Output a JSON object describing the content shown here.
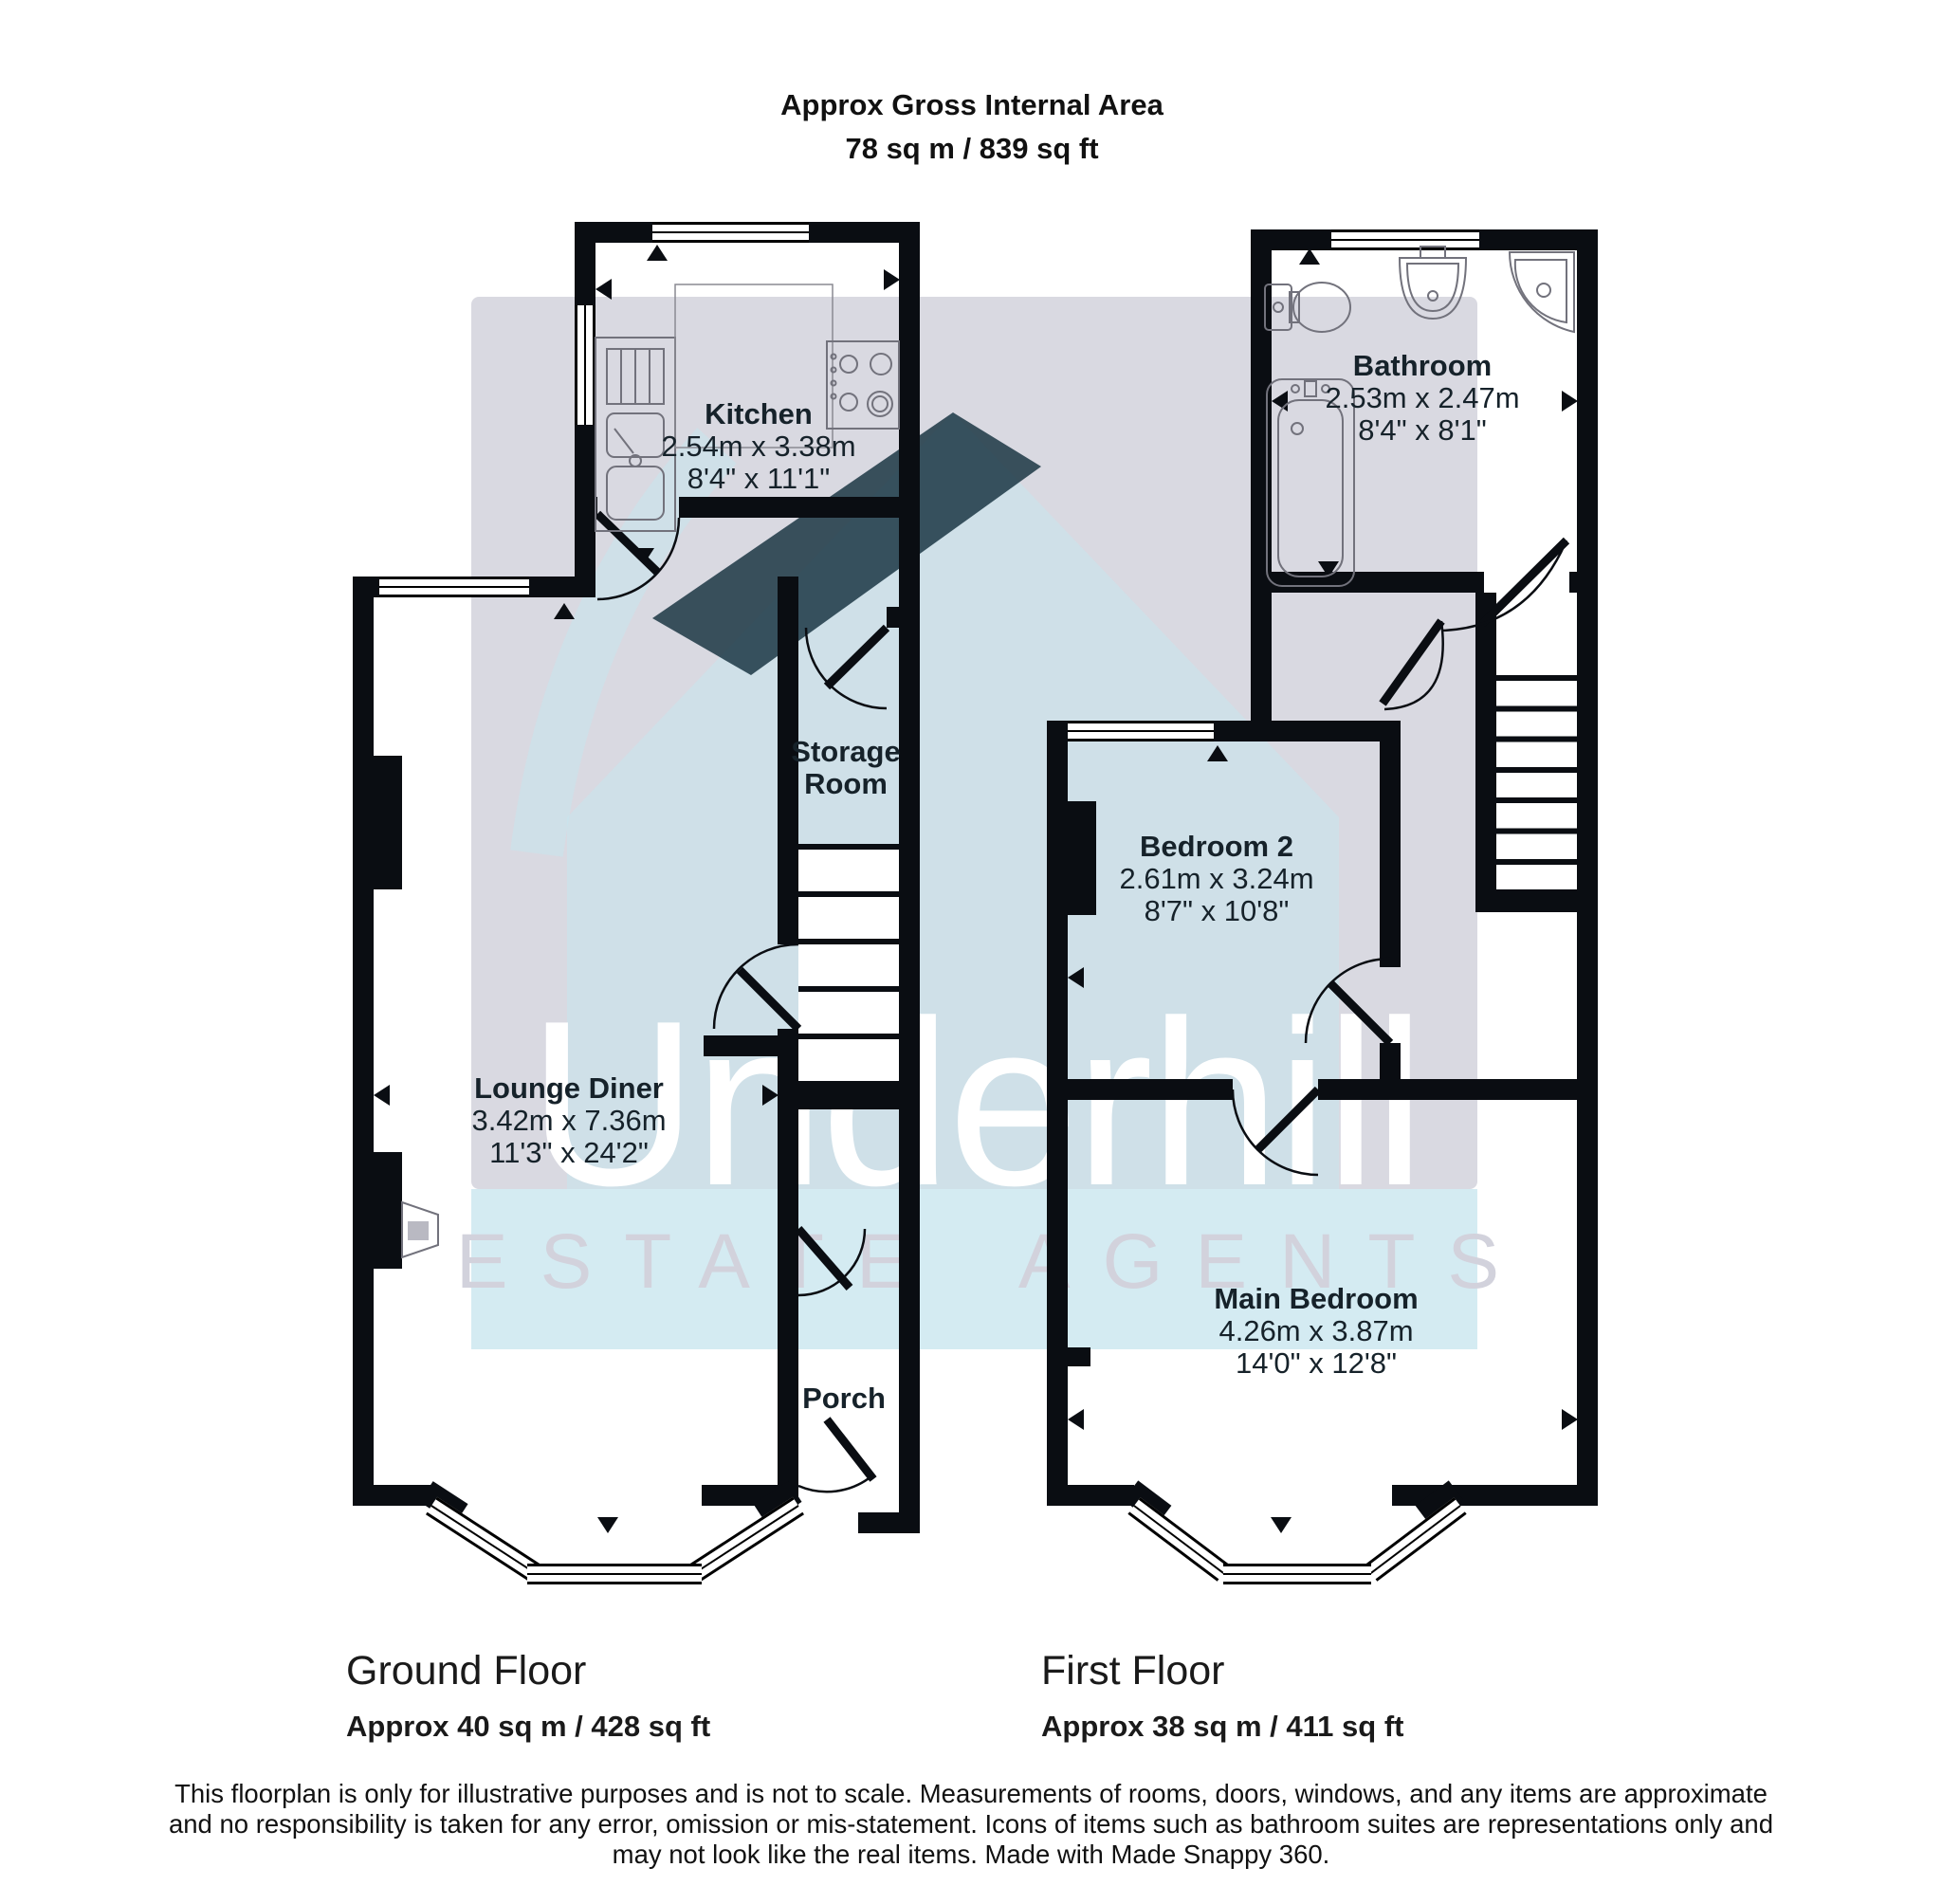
{
  "title": {
    "line1": "Approx Gross Internal Area",
    "line2": "78 sq m / 839 sq ft"
  },
  "watermark": {
    "brand": "Underhill",
    "tagline": "ESTATE AGENTS"
  },
  "rooms": {
    "kitchen": {
      "name": "Kitchen",
      "metric": "2.54m x 3.38m",
      "imperial": "8'4\" x 11'1\""
    },
    "storage": {
      "name_line1": "Storage",
      "name_line2": "Room"
    },
    "lounge": {
      "name": "Lounge Diner",
      "metric": "3.42m x 7.36m",
      "imperial": "11'3\" x 24'2\""
    },
    "porch": {
      "name": "Porch"
    },
    "bathroom": {
      "name": "Bathroom",
      "metric": "2.53m x 2.47m",
      "imperial": "8'4\" x 8'1\""
    },
    "bedroom2": {
      "name": "Bedroom 2",
      "metric": "2.61m x 3.24m",
      "imperial": "8'7\" x 10'8\""
    },
    "main_bedroom": {
      "name": "Main Bedroom",
      "metric": "4.26m x 3.87m",
      "imperial": "14'0\" x 12'8\""
    }
  },
  "floors": {
    "ground": {
      "name": "Ground Floor",
      "area": "Approx 40 sq m / 428 sq ft"
    },
    "first": {
      "name": "First Floor",
      "area": "Approx 38 sq m / 411 sq ft"
    }
  },
  "disclaimer": {
    "lines": [
      "This floorplan is only for illustrative purposes and is not to scale. Measurements of rooms, doors, windows, and any items are approximate",
      "and no responsibility is taken for any error, omission or mis-statement. Icons of items such as bathroom suites are representations only and",
      "may not look like the real items. Made with Made Snappy 360."
    ]
  },
  "colors": {
    "wall": "#0a0d12",
    "watermark_grey": "#d0d0da",
    "watermark_blue": "#cfe9f1",
    "roof_dark": "#0f2c3a",
    "brand_white": "#ffffff"
  }
}
